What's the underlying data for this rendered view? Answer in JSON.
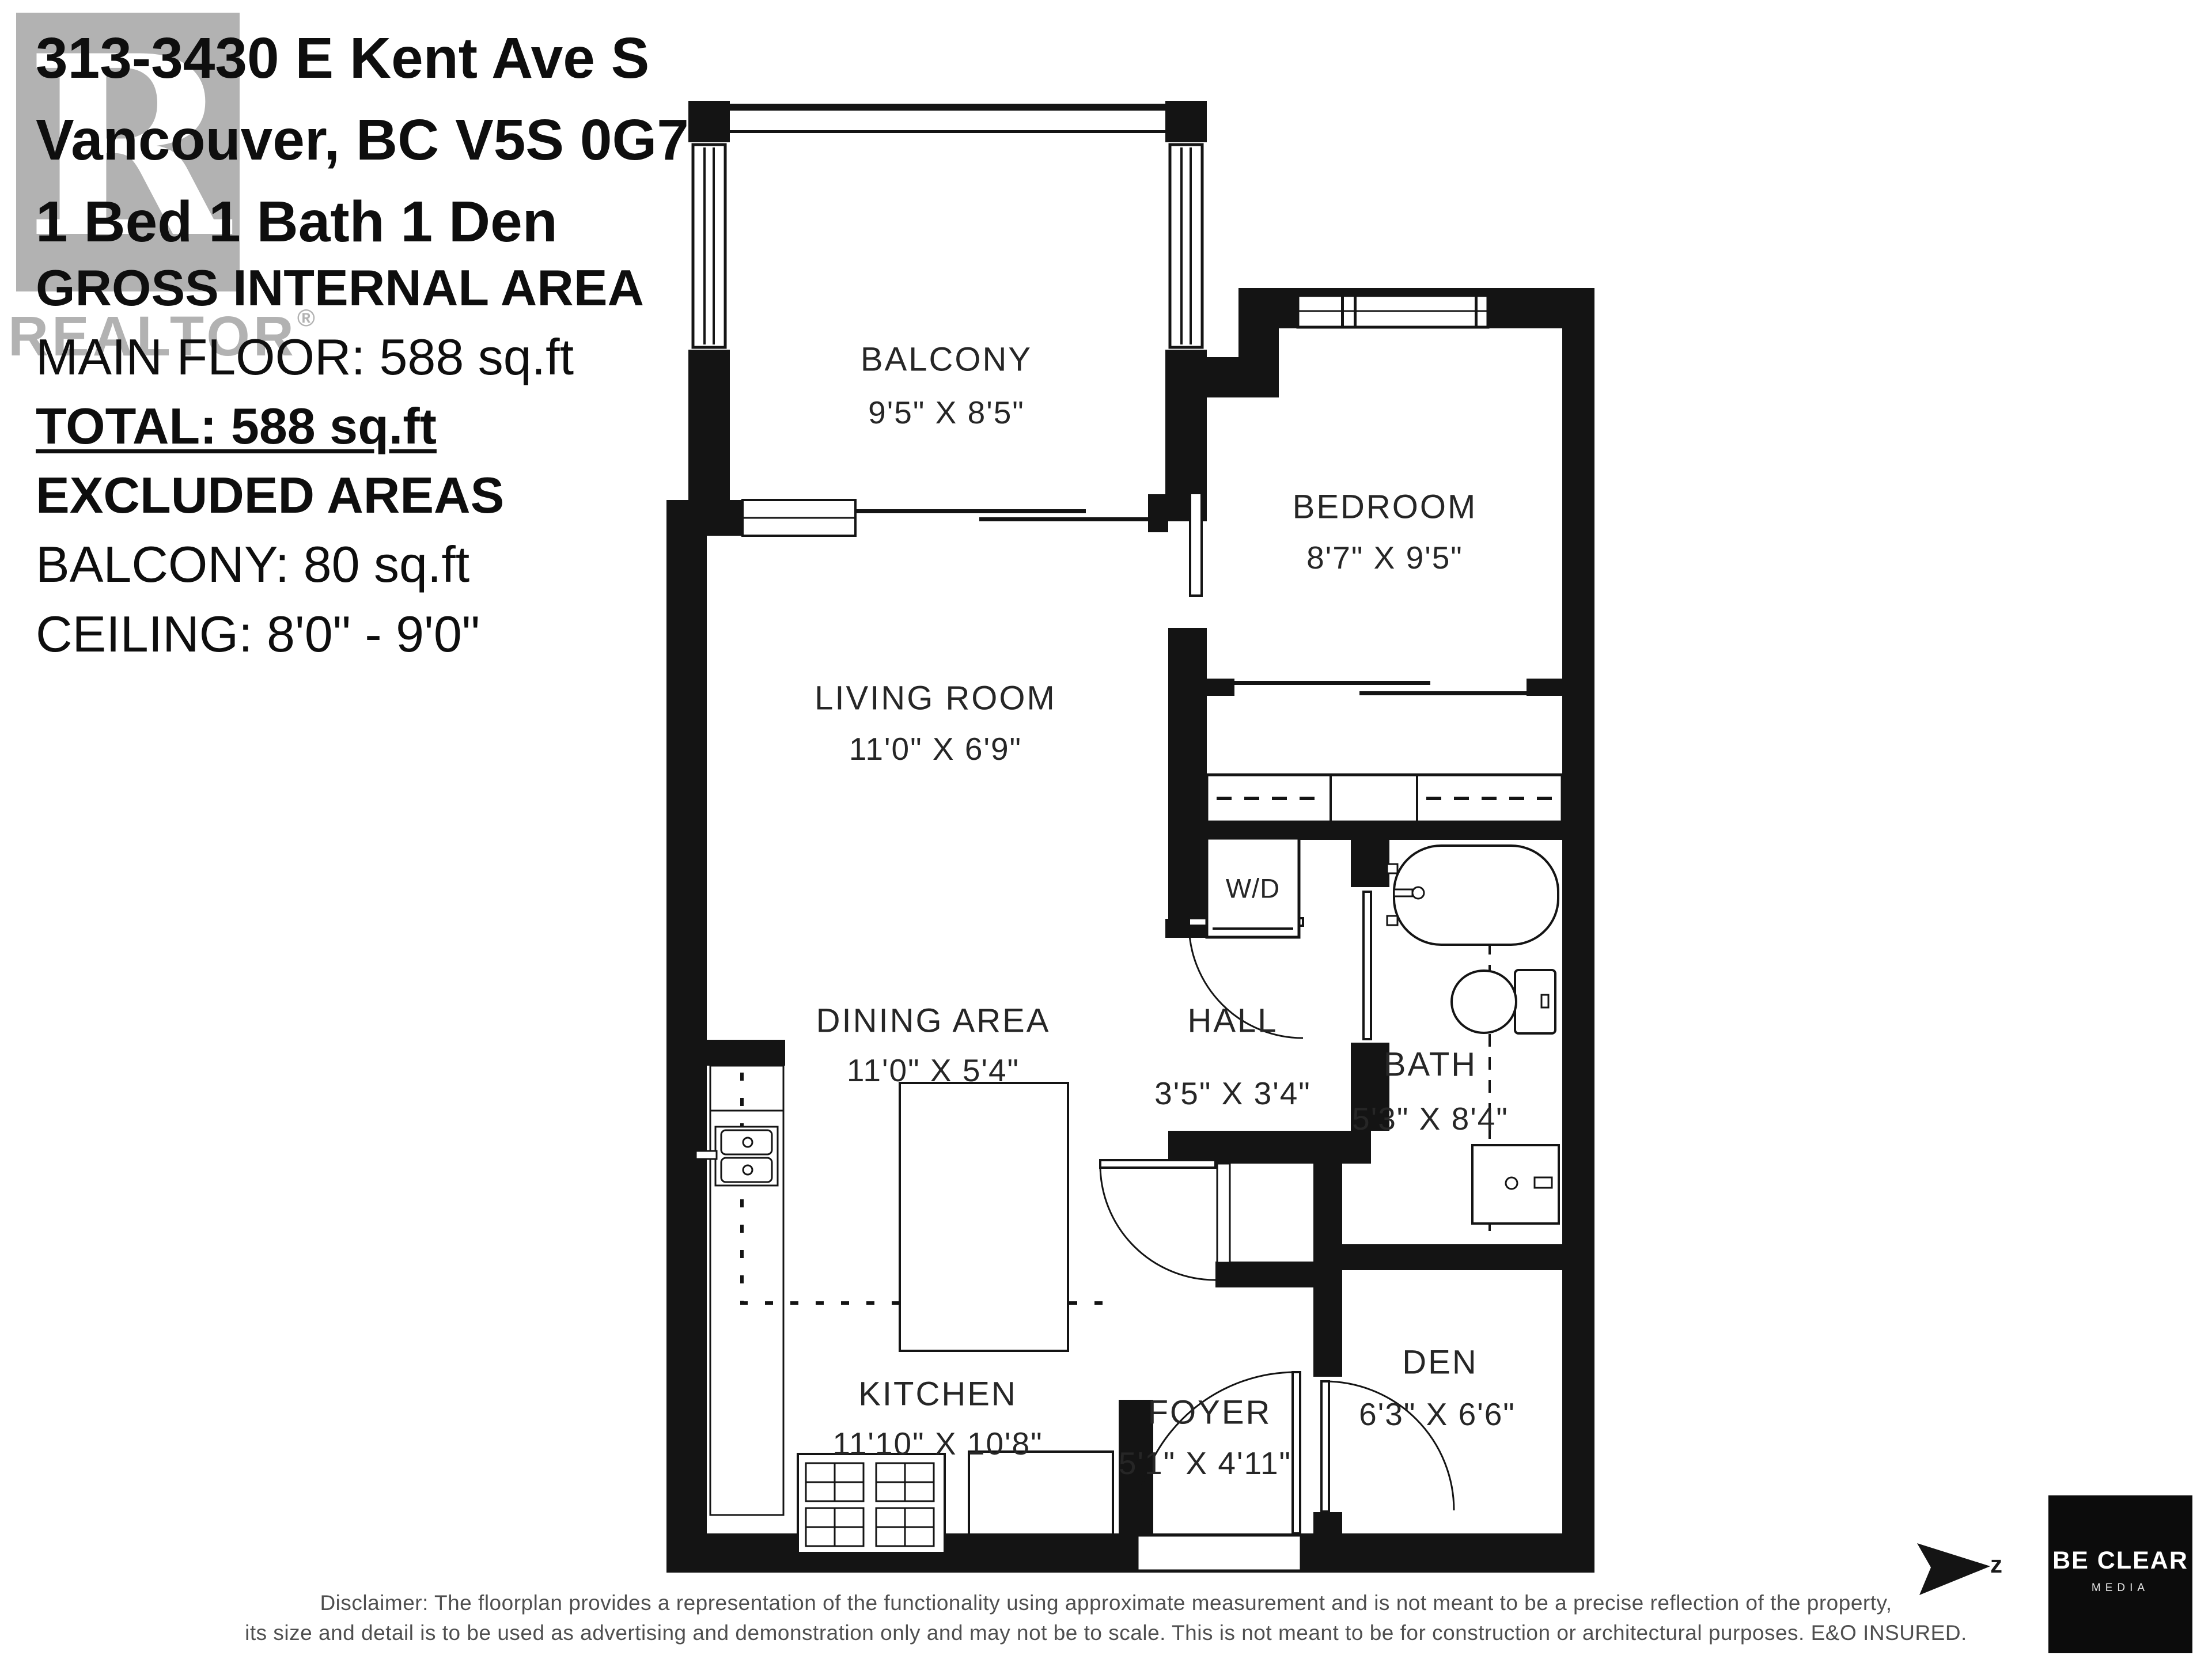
{
  "header": {
    "address_line1": "313-3430 E Kent Ave S",
    "address_line2": "Vancouver, BC V5S 0G7",
    "summary": "1 Bed 1 Bath 1 Den"
  },
  "area_info": {
    "title": "GROSS INTERNAL AREA",
    "main_floor": "MAIN FLOOR: 588 sq.ft",
    "total": "TOTAL: 588 sq.ft",
    "excluded_title": "EXCLUDED AREAS",
    "balcony": "BALCONY: 80 sq.ft",
    "ceiling": "CEILING: 8'0\" - 9'0\""
  },
  "watermark": {
    "letter": "R",
    "brand": "REALTOR",
    "reg": "®"
  },
  "rooms": {
    "balcony": {
      "name": "BALCONY",
      "dims": "9'5\" X 8'5\""
    },
    "bedroom": {
      "name": "BEDROOM",
      "dims": "8'7\" X 9'5\""
    },
    "living_room": {
      "name": "LIVING ROOM",
      "dims": "11'0\" X 6'9\""
    },
    "dining_area": {
      "name": "DINING AREA",
      "dims": "11'0\" X 5'4\""
    },
    "kitchen": {
      "name": "KITCHEN",
      "dims": "11'10\" X 10'8\""
    },
    "hall": {
      "name": "HALL",
      "dims": "3'5\" X 3'4\""
    },
    "bath": {
      "name": "BATH",
      "dims": "5'3\" X 8'4\""
    },
    "foyer": {
      "name": "FOYER",
      "dims": "5'1\" X 4'11\""
    },
    "den": {
      "name": "DEN",
      "dims": "6'3\" X 6'6\""
    },
    "laundry": {
      "name": "W/D"
    }
  },
  "compass": {
    "label": "z"
  },
  "logo": {
    "line1": "BE CLEAR",
    "line2": "MEDIA"
  },
  "disclaimer": {
    "line1": "Disclaimer: The floorplan provides a representation of the functionality using approximate measurement and is not meant to be a precise reflection of the property,",
    "line2": "its size and detail is to be used as advertising and demonstration only and may not be to scale. This is not meant to be for construction or architectural purposes. E&O INSURED."
  },
  "colors": {
    "wall": "#141414",
    "watermark_gray": "#b2b2b2",
    "logo_background": "#0c0c0c",
    "disclaimer_gray": "#4f4f4f"
  }
}
